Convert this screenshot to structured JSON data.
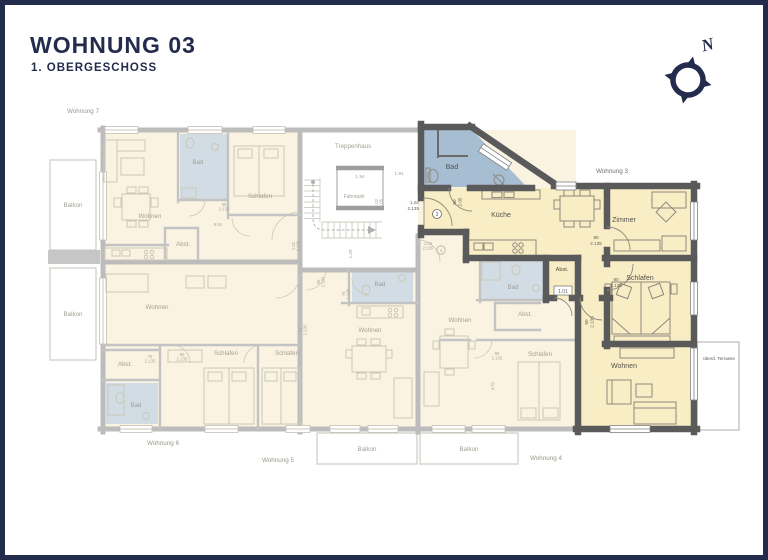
{
  "header": {
    "title": "WOHNUNG 03",
    "subtitle": "1. OBERGESCHOSS"
  },
  "compass": {
    "label": "N"
  },
  "colors": {
    "frame_navy": "#232c4d",
    "highlight_wall": "#5a5a5a",
    "faded_wall": "#bcbcbc",
    "highlight_room_yellow": "#f8edc4",
    "faded_room_cream": "#faf3e2",
    "highlight_bath_blue": "#a7bdd2",
    "faded_bath_blue": "#d2dce5"
  },
  "plan": {
    "balkon": "Balkon",
    "stairwell": {
      "name": "Treppenhaus",
      "elevator": "Fahrstuhl",
      "dim_a": "1.94",
      "dim_b": "1.91",
      "dim_c": "1.20"
    },
    "doors": {
      "d90w": "90",
      "d90h": "2.135",
      "d76w": "76",
      "d76h": "2.135",
      "d102w": "1.02",
      "d102h": "2.135",
      "d80w": "80",
      "d80h": "2.05",
      "liftw": "1.02",
      "lifth": "2.05"
    },
    "apartments": {
      "w3": {
        "name": "Wohnung 3",
        "unit": "3",
        "bad": "Bad",
        "kueche": "Küche",
        "zimmer": "Zimmer",
        "abst": "Abst.",
        "abst_code": "1.01",
        "schlafen": "Schlafen",
        "wohnen": "Wohnen",
        "terrasse": "überd. Terrasse"
      },
      "w7": {
        "name": "Wohnung 7",
        "wohnen": "Wohnen",
        "bad": "Bad",
        "schlafen": "Schlafen",
        "abst": "Abst.",
        "dim": "9.91"
      },
      "w6": {
        "name": "Wohnung 6",
        "wohnen": "Wohnen",
        "bad": "Bad",
        "schlafen1": "Schlafen",
        "schlafen2": "Schlafen",
        "abst": "Abst."
      },
      "w5": {
        "name": "Wohnung 5",
        "wohnen": "Wohnen",
        "bad": "Bad"
      },
      "w4": {
        "name": "Wohnung 4",
        "unit": "4",
        "wohnen": "Wohnen",
        "bad": "Bad",
        "schlafen": "Schlafen",
        "abst": "Abst.",
        "dim": "4.91"
      }
    }
  }
}
